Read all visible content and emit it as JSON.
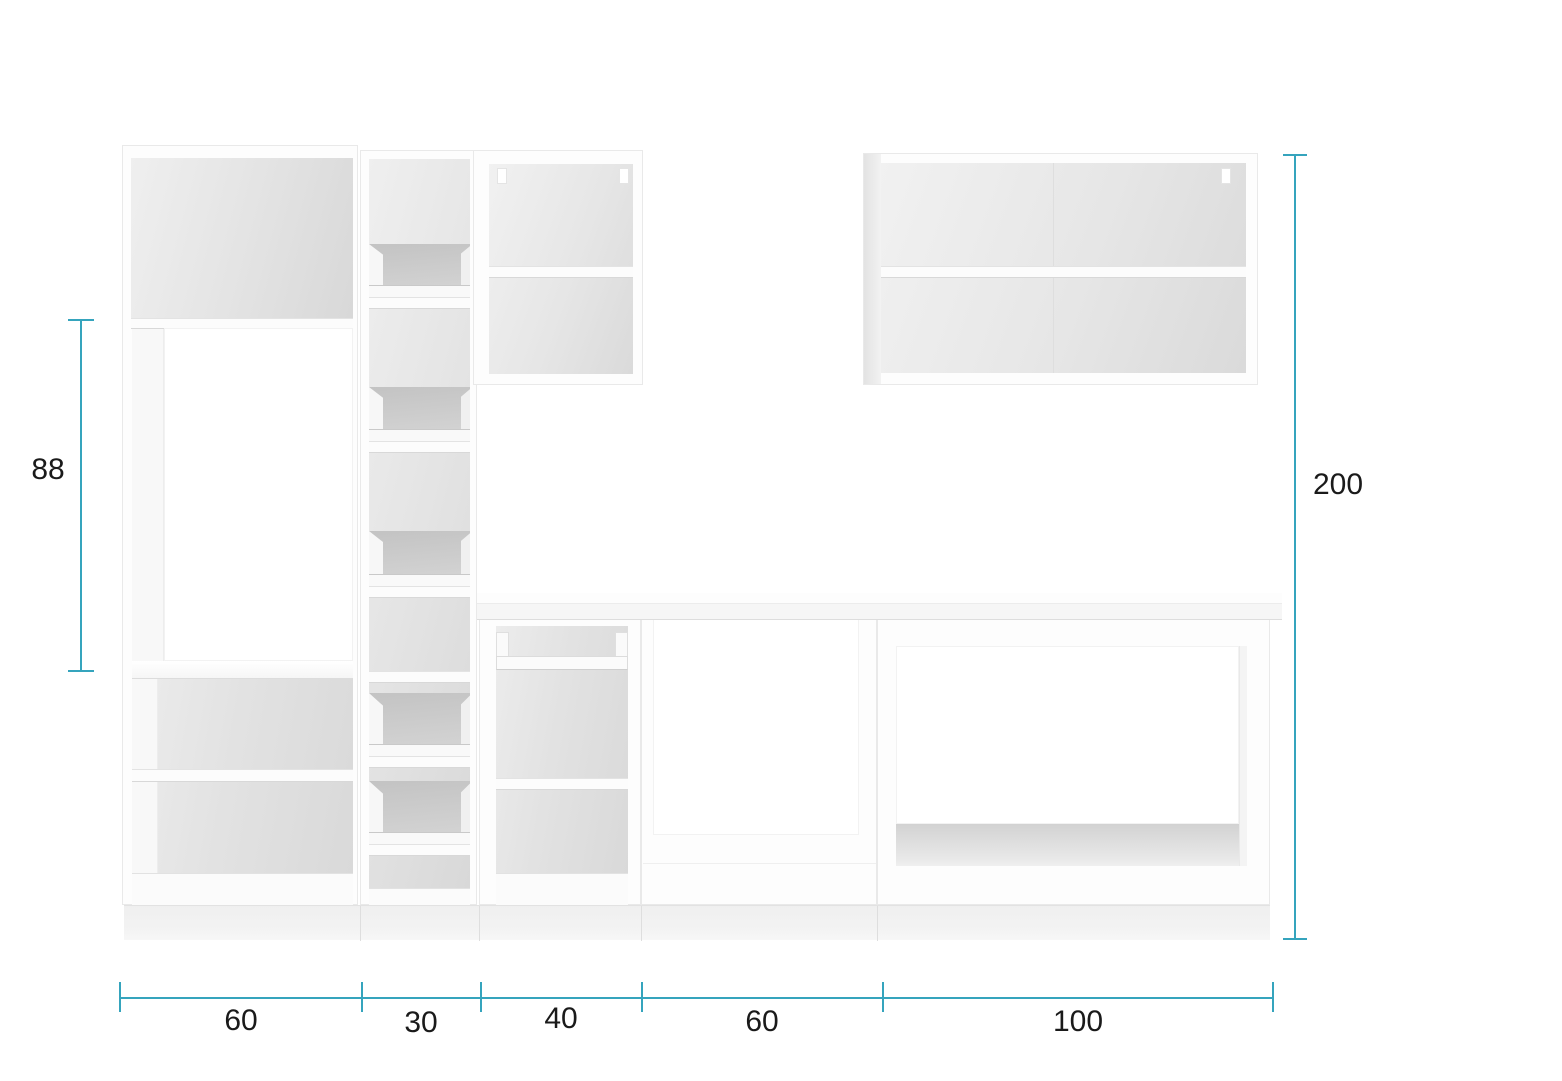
{
  "page": {
    "background": "#ffffff",
    "accent_color": "#35a4bd",
    "label_color": "#1a1a1a"
  },
  "dimensions": {
    "left_height": {
      "label": "88",
      "value": 88
    },
    "right_height": {
      "label": "200",
      "value": 200
    },
    "bottom_segments": [
      {
        "label": "60",
        "value": 60
      },
      {
        "label": "30",
        "value": 30
      },
      {
        "label": "40",
        "value": 40
      },
      {
        "label": "60",
        "value": 60
      },
      {
        "label": "100",
        "value": 100
      }
    ]
  }
}
